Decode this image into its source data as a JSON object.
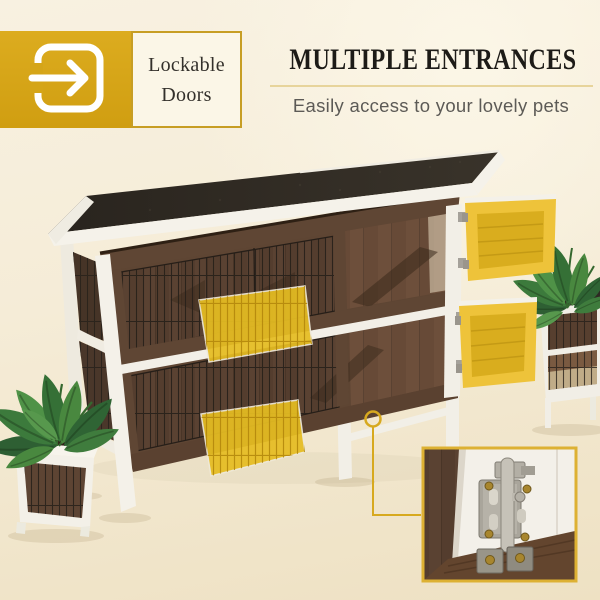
{
  "badge": {
    "icon": "door-enter-icon",
    "label": "Lockable Doors",
    "accent_color": "#D8A71B",
    "border_color": "#C79E24",
    "label_bg": "#FBF6E7",
    "label_text_color": "#33302B"
  },
  "header": {
    "title": "MULTIPLE ENTRANCES",
    "subtitle": "Easily access to your lovely pets",
    "title_color": "#1D1B17",
    "subtitle_color": "#5C5A56",
    "divider_color": "#E7D49B"
  },
  "scene": {
    "subject": "two-tier-wooden-rabbit-hutch-photo",
    "highlight_color": "#E8BE27",
    "highlighted_entrances": [
      "upper-right-side-door-open",
      "lower-right-side-door-open",
      "upper-front-mesh-ramp-door",
      "lower-front-mesh-ramp-door"
    ],
    "callout": {
      "target": "door-lock-area",
      "line_color": "#D7A91F"
    },
    "inset": {
      "subject": "stainless-latch-lock-closeup",
      "border_color": "#DDB133"
    },
    "colors": {
      "roof_felt": "#2E2822",
      "wood_frame": "#5E4533",
      "interior_wood": "#6B4E3A",
      "trim_white": "#F2EFE7",
      "wire_mesh": "#29221B",
      "leaf_green": "#3C7A3C",
      "background": "#F5ECD7"
    }
  }
}
